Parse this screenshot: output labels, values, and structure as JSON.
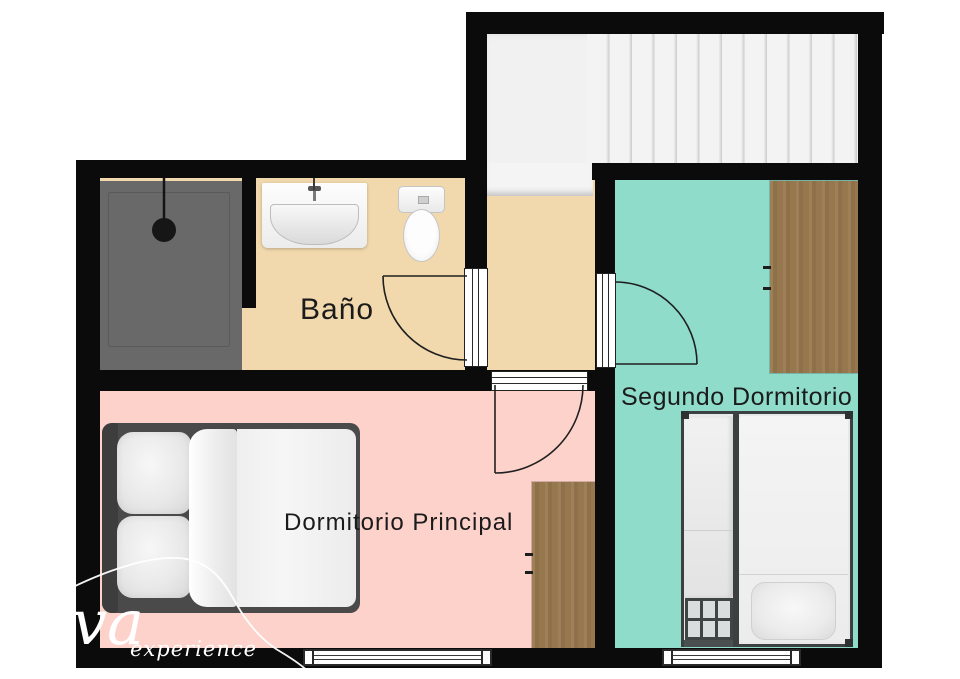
{
  "floor_plan": {
    "rooms": {
      "bathroom": {
        "label": "Baño"
      },
      "second_bedroom": {
        "label": "Segundo Dormitorio"
      },
      "main_bedroom": {
        "label": "Dormitorio Principal"
      }
    },
    "watermark": {
      "logo": "va",
      "tagline": "experience"
    }
  },
  "colors": {
    "wall": "#0b0b0b",
    "floorBath": "#f1d9ad",
    "floorHall": "#f1d9ad",
    "floorMain": "#fdd2cb",
    "floorSecond": "#8fdccb",
    "wood": "#97774e",
    "shower": "#696969",
    "stairs": "#f1f1f1",
    "line": "#1f1f1f",
    "paper": "#ffffff"
  }
}
